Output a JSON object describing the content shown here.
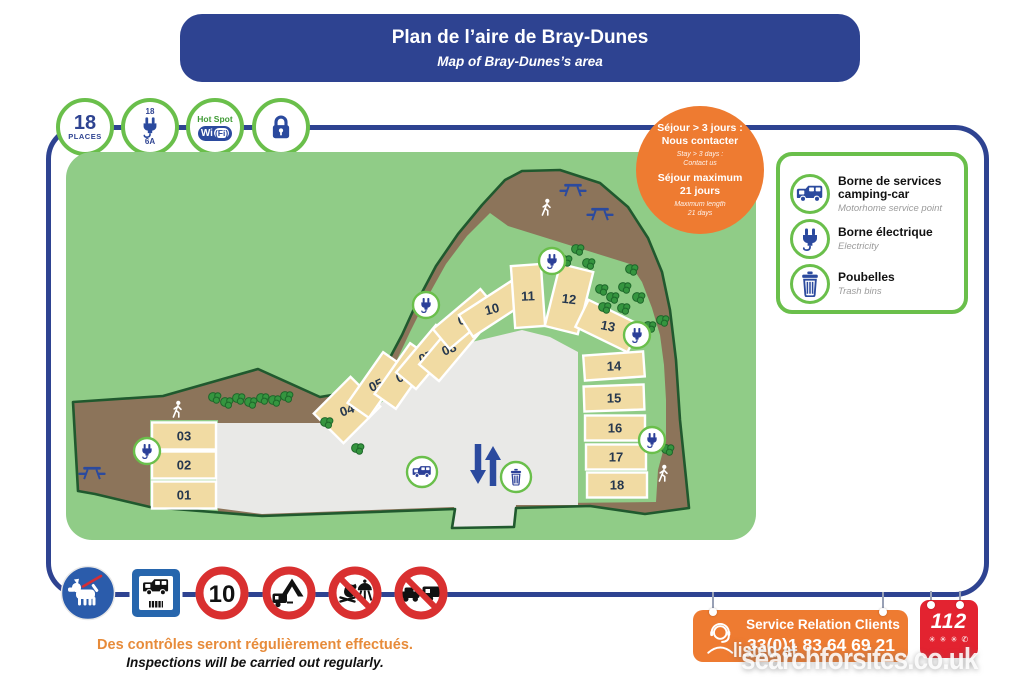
{
  "title": {
    "fr": "Plan de l’aire de Bray-Dunes",
    "en": "Map of Bray-Dunes’s area"
  },
  "top_icons": {
    "places_number": "18",
    "places_label": "PLACES",
    "amp_top": "18",
    "amp_bottom": "6A",
    "hotspot_label": "Hot Spot",
    "wifi_wi": "Wi",
    "wifi_fi": "(Fi)"
  },
  "stay_badge": {
    "fr1": "Séjour > 3 jours :",
    "fr2": "Nous contacter",
    "en1": "Stay > 3 days :",
    "en2": "Contact us",
    "fr3": "Séjour maximum",
    "fr4": "21 jours",
    "en3": "Maximum length",
    "en4": "21 days"
  },
  "legend": {
    "items": [
      {
        "icon": "motorhome-service-icon",
        "fr": "Borne de services camping-car",
        "en": "Motorhome service point"
      },
      {
        "icon": "electric-plug-icon",
        "fr": "Borne électrique",
        "en": "Electricity"
      },
      {
        "icon": "trash-bin-icon",
        "fr": "Poubelles",
        "en": "Trash bins"
      }
    ]
  },
  "map": {
    "site_outline": [
      [
        73,
        402
      ],
      [
        163,
        396
      ],
      [
        258,
        369
      ],
      [
        320,
        397
      ],
      [
        356,
        391
      ],
      [
        385,
        367
      ],
      [
        402,
        335
      ],
      [
        418,
        300
      ],
      [
        436,
        266
      ],
      [
        458,
        234
      ],
      [
        482,
        205
      ],
      [
        505,
        180
      ],
      [
        522,
        171
      ],
      [
        560,
        170
      ],
      [
        600,
        183
      ],
      [
        628,
        207
      ],
      [
        648,
        238
      ],
      [
        662,
        272
      ],
      [
        670,
        310
      ],
      [
        676,
        360
      ],
      [
        680,
        420
      ],
      [
        686,
        478
      ],
      [
        689,
        508
      ],
      [
        645,
        514
      ],
      [
        590,
        506
      ],
      [
        516,
        508
      ],
      [
        514,
        527
      ],
      [
        452,
        528
      ],
      [
        455,
        509
      ],
      [
        262,
        516
      ],
      [
        150,
        507
      ],
      [
        95,
        494
      ],
      [
        78,
        491
      ]
    ],
    "meadow": [
      [
        340,
        424
      ],
      [
        374,
        398
      ],
      [
        394,
        366
      ],
      [
        410,
        332
      ],
      [
        427,
        298
      ],
      [
        446,
        264
      ],
      [
        467,
        236
      ],
      [
        490,
        213
      ],
      [
        508,
        226
      ],
      [
        630,
        264
      ],
      [
        642,
        282
      ],
      [
        652,
        308
      ],
      [
        660,
        335
      ],
      [
        664,
        365
      ],
      [
        666,
        400
      ],
      [
        666,
        440
      ],
      [
        658,
        470
      ],
      [
        656,
        502
      ],
      [
        560,
        503
      ],
      [
        455,
        507
      ]
    ],
    "green_patches": [
      [
        150,
        420,
        68,
        92
      ],
      [
        580,
        348,
        70,
        154
      ]
    ],
    "road": [
      [
        216,
        423
      ],
      [
        330,
        423
      ],
      [
        343,
        432
      ],
      [
        455,
        346
      ],
      [
        522,
        330
      ],
      [
        550,
        337
      ],
      [
        578,
        352
      ],
      [
        578,
        505
      ],
      [
        516,
        505
      ],
      [
        514,
        527
      ],
      [
        452,
        528
      ],
      [
        454,
        507
      ],
      [
        262,
        514
      ],
      [
        216,
        508
      ]
    ],
    "spots": [
      {
        "n": "01",
        "x": 184,
        "y": 495,
        "w": 64,
        "h": 27,
        "r": 0
      },
      {
        "n": "02",
        "x": 184,
        "y": 465,
        "w": 64,
        "h": 27,
        "r": 0
      },
      {
        "n": "03",
        "x": 184,
        "y": 436,
        "w": 64,
        "h": 27,
        "r": 0
      },
      {
        "n": "04",
        "x": 347,
        "y": 410,
        "w": 52,
        "h": 42,
        "r": -45
      },
      {
        "n": "05",
        "x": 376,
        "y": 385,
        "w": 62,
        "h": 26,
        "r": -55
      },
      {
        "n": "06",
        "x": 403,
        "y": 376,
        "w": 62,
        "h": 26,
        "r": -55
      },
      {
        "n": "07",
        "x": 426,
        "y": 357,
        "w": 62,
        "h": 26,
        "r": -50
      },
      {
        "n": "08",
        "x": 449,
        "y": 349,
        "w": 62,
        "h": 26,
        "r": -50
      },
      {
        "n": "09",
        "x": 465,
        "y": 319,
        "w": 62,
        "h": 26,
        "r": -40
      },
      {
        "n": "10",
        "x": 492,
        "y": 309,
        "w": 62,
        "h": 26,
        "r": -33
      },
      {
        "n": "11",
        "x": 528,
        "y": 296,
        "w": 30,
        "h": 62,
        "r": -4
      },
      {
        "n": "12",
        "x": 569,
        "y": 299,
        "w": 34,
        "h": 64,
        "r": 14
      },
      {
        "n": "13",
        "x": 608,
        "y": 326,
        "w": 58,
        "h": 30,
        "r": 26
      },
      {
        "n": "14",
        "x": 614,
        "y": 366,
        "w": 60,
        "h": 25,
        "r": -4
      },
      {
        "n": "15",
        "x": 614,
        "y": 398,
        "w": 60,
        "h": 25,
        "r": -2
      },
      {
        "n": "16",
        "x": 615,
        "y": 428,
        "w": 60,
        "h": 25,
        "r": 0
      },
      {
        "n": "17",
        "x": 616,
        "y": 457,
        "w": 60,
        "h": 25,
        "r": 0
      },
      {
        "n": "18",
        "x": 617,
        "y": 485,
        "w": 60,
        "h": 25,
        "r": 0
      }
    ],
    "plug_markers": [
      [
        147,
        451
      ],
      [
        426,
        305
      ],
      [
        552,
        261
      ],
      [
        637,
        335
      ],
      [
        652,
        440
      ]
    ],
    "service_marker": [
      422,
      472
    ],
    "trash_marker": [
      516,
      477
    ],
    "picnic_tables": [
      [
        92,
        472
      ],
      [
        573,
        189
      ],
      [
        600,
        213
      ]
    ],
    "persons": [
      [
        177,
        410
      ],
      [
        546,
        208
      ],
      [
        663,
        474
      ]
    ],
    "trees": [
      [
        215,
        398
      ],
      [
        227,
        403
      ],
      [
        239,
        399
      ],
      [
        251,
        403
      ],
      [
        263,
        399
      ],
      [
        275,
        401
      ],
      [
        287,
        397
      ],
      [
        327,
        423
      ],
      [
        358,
        449
      ],
      [
        578,
        250
      ],
      [
        566,
        261
      ],
      [
        589,
        264
      ],
      [
        602,
        290
      ],
      [
        613,
        298
      ],
      [
        625,
        288
      ],
      [
        605,
        308
      ],
      [
        632,
        270
      ],
      [
        639,
        298
      ],
      [
        650,
        327
      ],
      [
        663,
        321
      ],
      [
        624,
        309
      ],
      [
        668,
        450
      ]
    ],
    "arrows": {
      "down": [
        478,
        444,
        478,
        472
      ],
      "up": [
        493,
        486,
        493,
        458
      ]
    }
  },
  "signs": {
    "speed": "10"
  },
  "notice": {
    "fr": "Des contrôles seront régulièrement effectués.",
    "en": "Inspections will be carried out regularly."
  },
  "service_box": {
    "title": "Service Relation Clients",
    "phone": "33(0)1 83 64 69 21"
  },
  "emergency": {
    "number": "112",
    "icons": "✳ ✳ ✳ ✆"
  },
  "watermark": {
    "small": "listed at",
    "big": "searchforsites.co.uk"
  },
  "colors": {
    "blue": "#2e4391",
    "icon_blue": "#2b4a9e",
    "green_border": "#6abf4b",
    "lawn": "#90cc87",
    "outline": "#20592e",
    "brown": "#8c745a",
    "beige": "#f1dba3",
    "road_gray": "#e9e9e7",
    "orange": "#ee7b31",
    "sign_red": "#d93030",
    "emergency_red": "#e32330",
    "tree": "#35953f"
  }
}
